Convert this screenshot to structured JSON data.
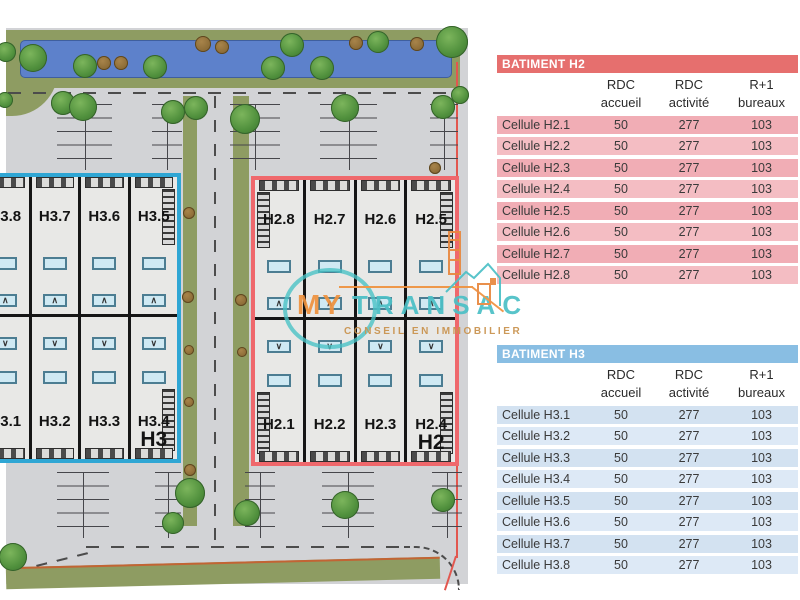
{
  "plan": {
    "building_h3": {
      "outline_color": "#2fa6d4",
      "big_label": "H3",
      "top_cells": [
        "H3.8",
        "H3.7",
        "H3.6",
        "H3.5"
      ],
      "bottom_cells": [
        "H3.1",
        "H3.2",
        "H3.3",
        "H3.4"
      ]
    },
    "building_h2": {
      "outline_color": "#ef686c",
      "big_label": "H2",
      "top_cells": [
        "H2.8",
        "H2.7",
        "H2.6",
        "H2.5"
      ],
      "bottom_cells": [
        "H2.1",
        "H2.2",
        "H2.3",
        "H2.4"
      ]
    }
  },
  "logo": {
    "word_my": "MY",
    "word_transac": "TRANSAC",
    "tagline": "CONSEIL EN IMMOBILIER",
    "orange": "#ef923f",
    "teal": "#4cc0c6",
    "tagline_color": "#c9924d"
  },
  "tables": [
    {
      "title": "BATIMENT H2",
      "title_bg": "#e66f6e",
      "row_colors": [
        "#f1adb5",
        "#f4bdc3"
      ],
      "columns": [
        [
          "RDC",
          "accueil"
        ],
        [
          "RDC",
          "activité"
        ],
        [
          "R+1",
          "bureaux"
        ]
      ],
      "rows": [
        [
          "Cellule H2.1",
          "50",
          "277",
          "103"
        ],
        [
          "Cellule H2.2",
          "50",
          "277",
          "103"
        ],
        [
          "Cellule H2.3",
          "50",
          "277",
          "103"
        ],
        [
          "Cellule H2.4",
          "50",
          "277",
          "103"
        ],
        [
          "Cellule H2.5",
          "50",
          "277",
          "103"
        ],
        [
          "Cellule H2.6",
          "50",
          "277",
          "103"
        ],
        [
          "Cellule H2.7",
          "50",
          "277",
          "103"
        ],
        [
          "Cellule H2.8",
          "50",
          "277",
          "103"
        ]
      ]
    },
    {
      "title": "BATIMENT H3",
      "title_bg": "#89bee3",
      "row_colors": [
        "#d3e2f1",
        "#dde9f6"
      ],
      "columns": [
        [
          "RDC",
          "accueil"
        ],
        [
          "RDC",
          "activité"
        ],
        [
          "R+1",
          "bureaux"
        ]
      ],
      "rows": [
        [
          "Cellule H3.1",
          "50",
          "277",
          "103"
        ],
        [
          "Cellule H3.2",
          "50",
          "277",
          "103"
        ],
        [
          "Cellule H3.3",
          "50",
          "277",
          "103"
        ],
        [
          "Cellule H3.4",
          "50",
          "277",
          "103"
        ],
        [
          "Cellule H3.5",
          "50",
          "277",
          "103"
        ],
        [
          "Cellule H3.6",
          "50",
          "277",
          "103"
        ],
        [
          "Cellule H3.7",
          "50",
          "277",
          "103"
        ],
        [
          "Cellule H3.8",
          "50",
          "277",
          "103"
        ]
      ]
    }
  ]
}
